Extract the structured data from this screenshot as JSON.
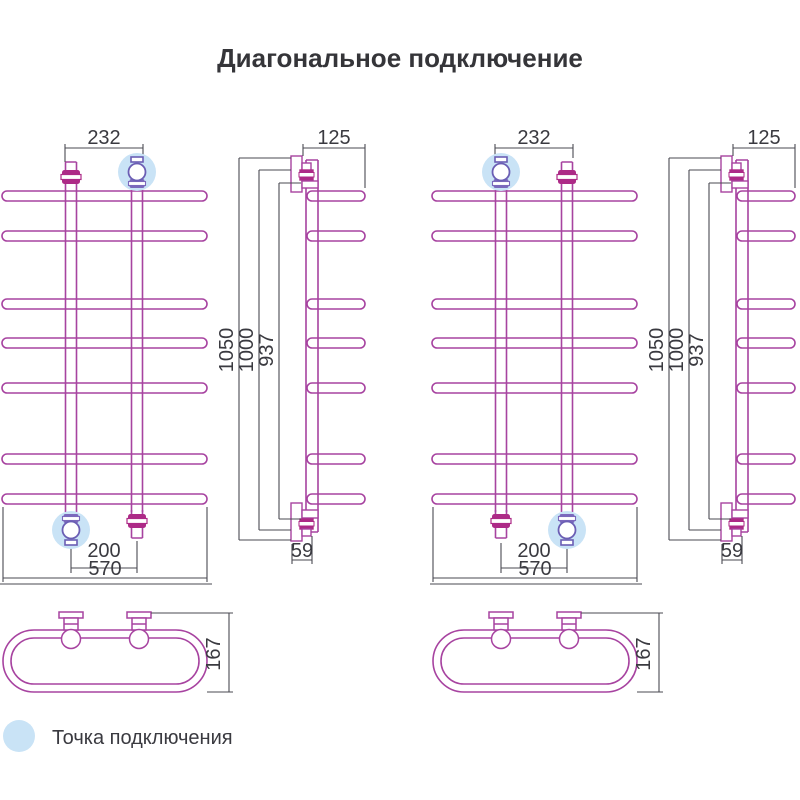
{
  "title": "Диагональное подключение",
  "legend": {
    "label": "Точка подключения"
  },
  "colors": {
    "pipe_line": "#A743A0",
    "valve_fill": "#AD2A87",
    "highlight_valve": "#6B5EB4",
    "connection_point_halo": "#C9E3F6",
    "dimension_line": "#4A4A52",
    "text": "#3A3A40"
  },
  "views": {
    "front": {
      "dims": {
        "top_connection_width": "232",
        "bottom_connection_width": "200",
        "overall_width": "570"
      }
    },
    "side": {
      "dims": {
        "depth": "125",
        "overall_height": "1050",
        "connection_height": "1000",
        "inner_height": "937",
        "bottom_offset": "59"
      }
    },
    "top": {
      "dims": {
        "depth": "167"
      }
    }
  }
}
